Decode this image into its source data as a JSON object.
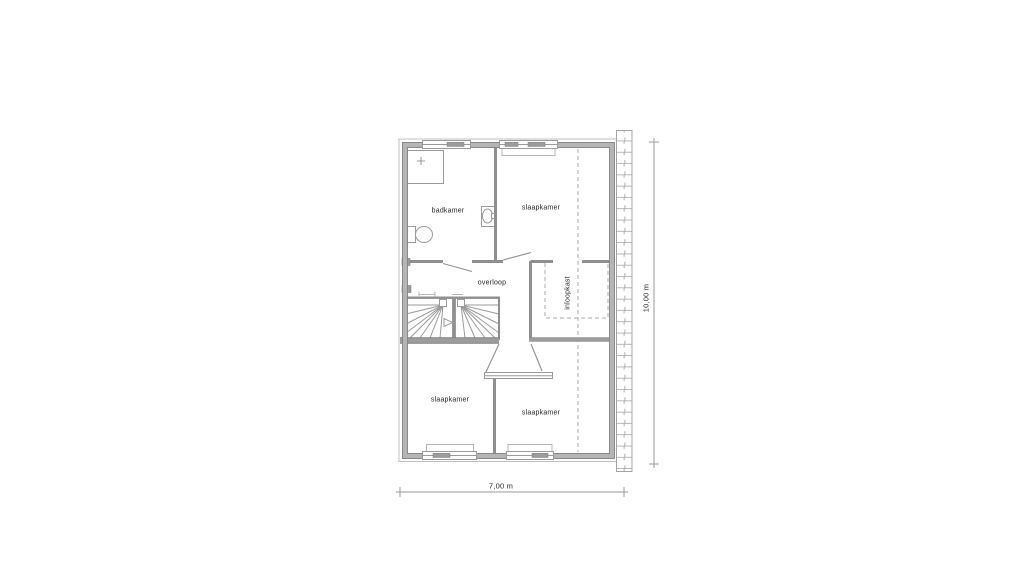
{
  "plan": {
    "title": "floor-plan-first-floor",
    "rooms": [
      {
        "name": "badkamer",
        "label": "badkamer"
      },
      {
        "name": "slaapkamer-top",
        "label": "slaapkamer"
      },
      {
        "name": "overloop",
        "label": "overloop"
      },
      {
        "name": "inloopkast",
        "label": "inloopkast"
      },
      {
        "name": "slaapkamer-bottom-left",
        "label": "slaapkamer"
      },
      {
        "name": "slaapkamer-bottom-right",
        "label": "slaapkamer"
      }
    ],
    "dimensions": {
      "width_label": "7,00 m",
      "height_label": "10,00 m"
    },
    "fixtures": [
      {
        "name": "shower"
      },
      {
        "name": "toilet"
      },
      {
        "name": "washbasin"
      },
      {
        "name": "staircase"
      },
      {
        "name": "stair-direction-arrow"
      }
    ],
    "colors": {
      "background": "#ffffff",
      "wall_fill": "#b5b5b5",
      "wall_dark": "#9c9c9c",
      "line": "#8f8f8f",
      "thin_line": "#9a9a9a",
      "text": "#1f1f1f"
    }
  }
}
